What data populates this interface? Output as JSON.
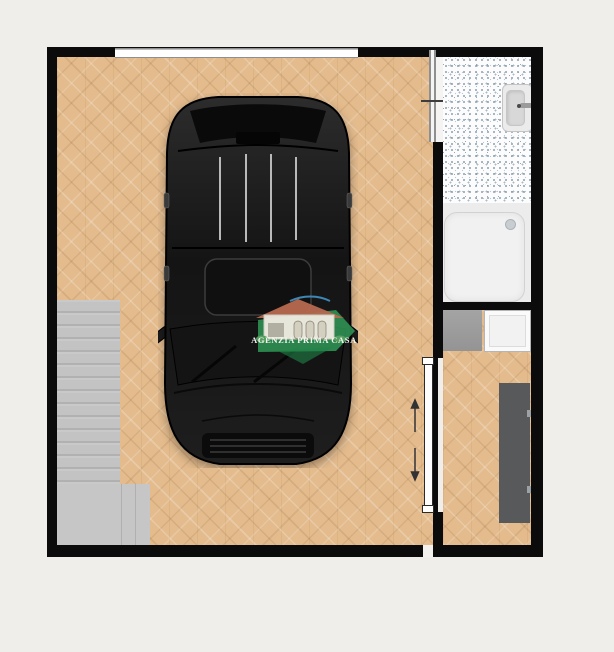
{
  "page": {
    "background_color": "#f0eeea"
  },
  "watermark": {
    "agency_name": "AGENZIA PRIMA CASA",
    "banner_color": "#2f9e58",
    "text_color": "#f3f6f0",
    "house_roof_color": "#b76a50"
  },
  "floorplan": {
    "wall_color": "#0b0b0b",
    "rooms": [
      {
        "name": "garage",
        "floor": "herringbone-wood",
        "floor_color": "#e3bb8d",
        "contents": [
          "car-top-view",
          "staircase",
          "window"
        ]
      },
      {
        "name": "bathroom",
        "floor": "speckled-tile",
        "floor_color": "#fcfcfc",
        "contents": [
          "sink",
          "shower-tray",
          "shower-drain",
          "pocket-door"
        ]
      },
      {
        "name": "utility-room",
        "floor": "herringbone-wood",
        "floor_color": "#e3bb8d",
        "contents": [
          "counter",
          "appliance",
          "wardrobe",
          "sliding-door"
        ]
      }
    ],
    "car_color": "#1a1a1a",
    "stairs_color": "#c6c6c6",
    "wardrobe_color": "#57595b",
    "counter_color": "#9c9c9c",
    "shower_color": "#f1f1f1",
    "sliding_door_arrows": [
      "up",
      "down"
    ]
  }
}
